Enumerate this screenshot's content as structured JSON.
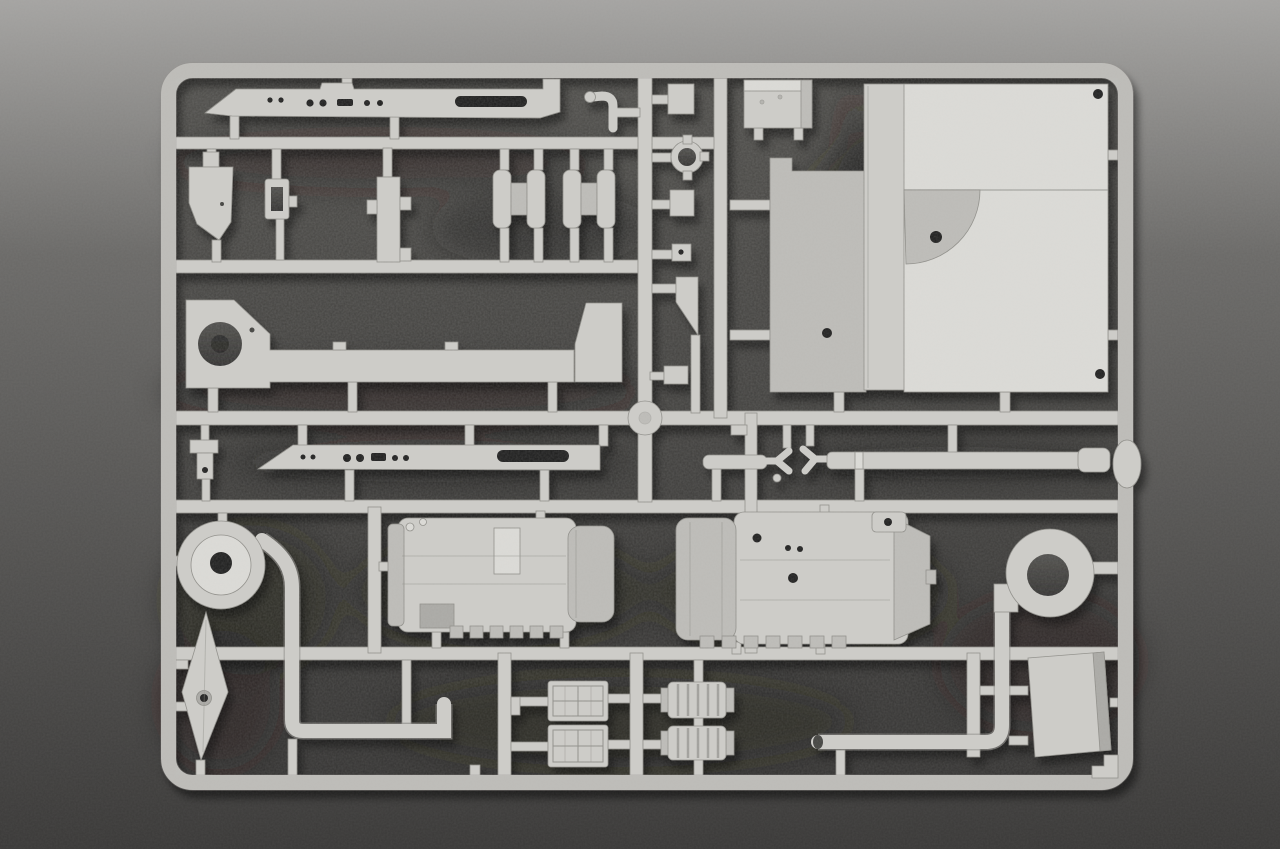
{
  "scene": {
    "type": "photograph",
    "subject": "light gray injection-molded plastic model kit sprue (parts tree) lying on a dark gray speckled surface",
    "palette": {
      "background_top": "#a5a4a2",
      "background_mid": "#6b6a68",
      "background_bottom": "#3a3938",
      "interior_top": "#4e4d4a",
      "interior_bottom": "#323130",
      "plastic_base": "#cdccc8",
      "plastic_light": "#dcdbd7",
      "plastic_mid": "#bcbbb7",
      "plastic_dark": "#a9a8a4",
      "plastic_outline": "#8e8d88",
      "hole_dark": "#1d1c1b",
      "shadow_blob": "#1e1d1c"
    },
    "sprue": {
      "frame_shape": "rounded rectangle runner frame with internal cross runners",
      "parts": [
        {
          "name": "top-fender-skirt",
          "desc": "long flat side skirt with lightening holes, pointed left end"
        },
        {
          "name": "trapezoid-bracket",
          "desc": "small tapered plate"
        },
        {
          "name": "buckle-frame",
          "desc": "small rectangular frame with slot"
        },
        {
          "name": "support-strip",
          "desc": "narrow vertical strip with side tabs"
        },
        {
          "name": "return-roller-pair-1",
          "desc": "double-flanged roller"
        },
        {
          "name": "return-roller-pair-2",
          "desc": "double-flanged roller"
        },
        {
          "name": "periscope-hook",
          "desc": "small curved stem part"
        },
        {
          "name": "eyelet-ring",
          "desc": "small ring with four tabs"
        },
        {
          "name": "small-block-a",
          "desc": "small rectangular block"
        },
        {
          "name": "small-block-b",
          "desc": "small rectangular block"
        },
        {
          "name": "pierced-square",
          "desc": "tiny square with center hole"
        },
        {
          "name": "wedge-vane",
          "desc": "small wedge plate"
        },
        {
          "name": "stowage-box",
          "desc": "rectangular box"
        },
        {
          "name": "hull-panel-left",
          "desc": "tall shaded side panel with hole"
        },
        {
          "name": "hull-plate-middle",
          "desc": "tall thin plate"
        },
        {
          "name": "hull-panel-main",
          "desc": "large bright roof panel with seam, quarter-round recess and rivet holes"
        },
        {
          "name": "hull-side-strip",
          "desc": "long side piece with large round opening at left and raised end block"
        },
        {
          "name": "bottom-fender-skirt",
          "desc": "second long skirt with holes and oval slot"
        },
        {
          "name": "tow-rod-with-forks",
          "desc": "short rod and two forked clevis bits"
        },
        {
          "name": "gun-barrel",
          "desc": "long tapered barrel with muzzle collar"
        },
        {
          "name": "fan-volute-with-pipe",
          "desc": "round fan housing flowing into long elbow pipe"
        },
        {
          "name": "blade-vane",
          "desc": "kite-shaped blade with hub hole"
        },
        {
          "name": "engine-cylinder-left",
          "desc": "large ribbed cylindrical engine/muffler body"
        },
        {
          "name": "engine-cylinder-right",
          "desc": "second ribbed cylindrical body with end cap and drilled bosses"
        },
        {
          "name": "grid-hatch-doors",
          "desc": "two latticed hatch doors"
        },
        {
          "name": "ribbed-couplings",
          "desc": "two small corrugated sleeve parts"
        },
        {
          "name": "exhaust-loop-pipe",
          "desc": "pipe with circular loop intake and long lower run"
        },
        {
          "name": "flat-panel-small",
          "desc": "small flat rectangular plate"
        },
        {
          "name": "corner-step-bracket",
          "desc": "stepped bracket in bottom-right frame corner"
        },
        {
          "name": "t-bracket",
          "desc": "small T bracket with hole"
        }
      ]
    }
  }
}
